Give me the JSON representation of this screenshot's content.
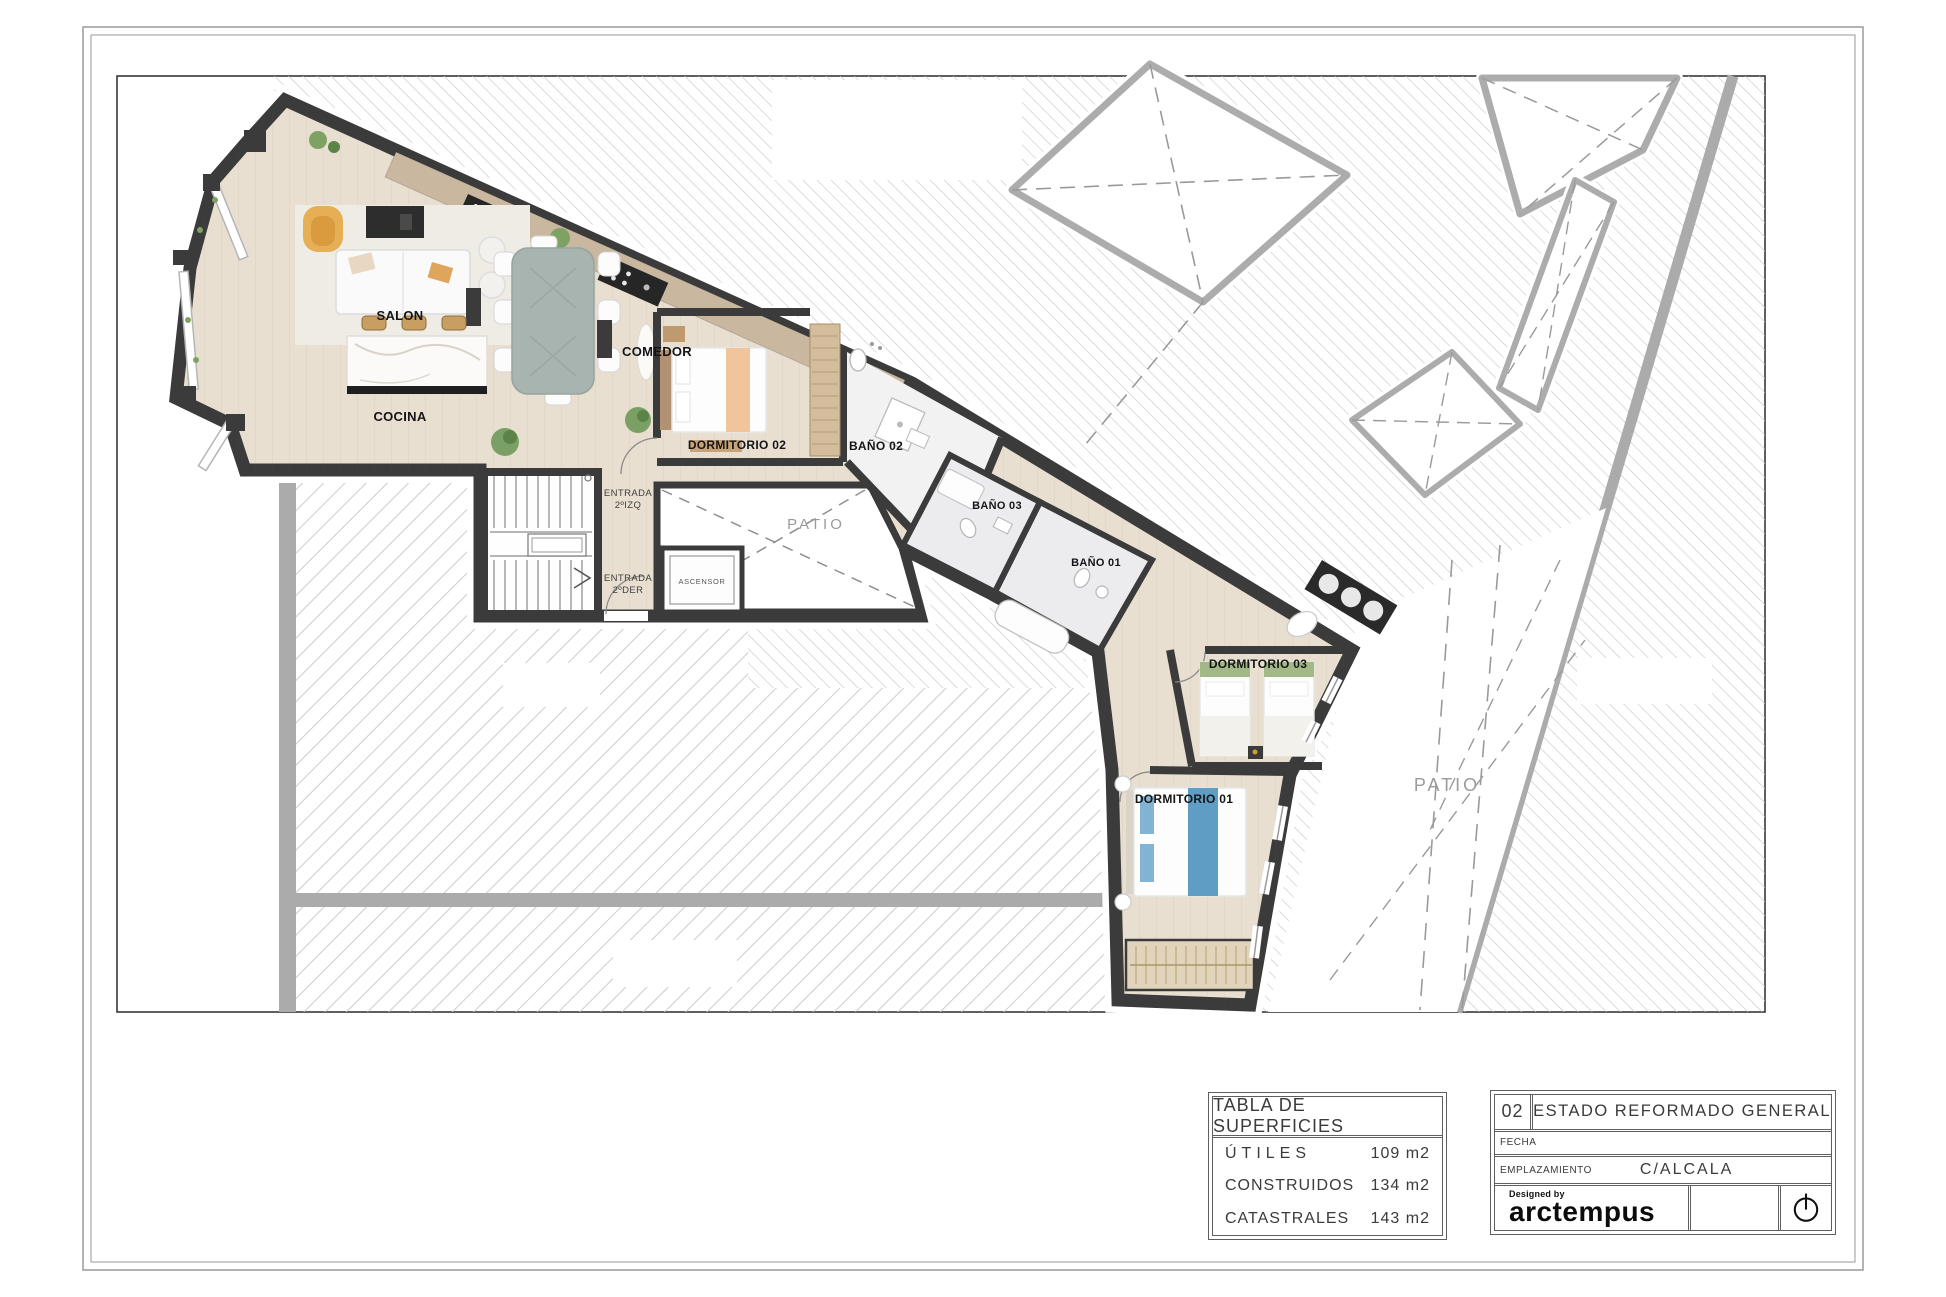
{
  "sheet": {
    "kind": "architectural floor plan",
    "sheet_number": "02",
    "sheet_title": "ESTADO REFORMADO GENERAL"
  },
  "rooms": {
    "salon": "SALON",
    "cocina": "COCINA",
    "comedor": "COMEDOR",
    "dormitorio02": "DORMITORIO 02",
    "bano02": "BAÑO 02",
    "bano03": "BAÑO 03",
    "bano01": "BAÑO 01",
    "dormitorio03": "DORMITORIO 03",
    "dormitorio01": "DORMITORIO 01",
    "ascensor": "ASCENSOR",
    "patio_small": "PATIO",
    "patio_large": "PATIO"
  },
  "annotations": {
    "entrada_izq_line1": "ENTRADA",
    "entrada_izq_line2": "2ºIZQ",
    "entrada_der_line1": "ENTRADA",
    "entrada_der_line2": "2ºDER"
  },
  "surface_table": {
    "title": "TABLA DE SUPERFICIES",
    "rows": [
      {
        "label": "ÚTILES",
        "value": "109 m2"
      },
      {
        "label": "CONSTRUIDOS",
        "value": "134 m2"
      },
      {
        "label": "CATASTRALES",
        "value": "143 m2"
      }
    ]
  },
  "title_block": {
    "sheet_number": "02",
    "sheet_title": "ESTADO REFORMADO GENERAL",
    "fecha_label": "FECHA",
    "fecha_value": "",
    "emplazamiento_label": "EMPLAZAMIENTO",
    "emplazamiento_value": "C/ALCALA",
    "designed_by": "Designed by",
    "brand": "arctempus"
  },
  "colors": {
    "wall": "#3b3b3b",
    "wood_floor": "#e8dfd1",
    "bath_floor": "#ececef",
    "hatch_line": "#c9c9c9",
    "neighbor_wall": "#ababab",
    "patio_text": "#9b9b9b",
    "accent_armchair": "#e6ae55",
    "accent_bed_blue": "#5f9dc4",
    "accent_bed_green": "#a3b887",
    "accent_bed_peach": "#f2c49b"
  }
}
